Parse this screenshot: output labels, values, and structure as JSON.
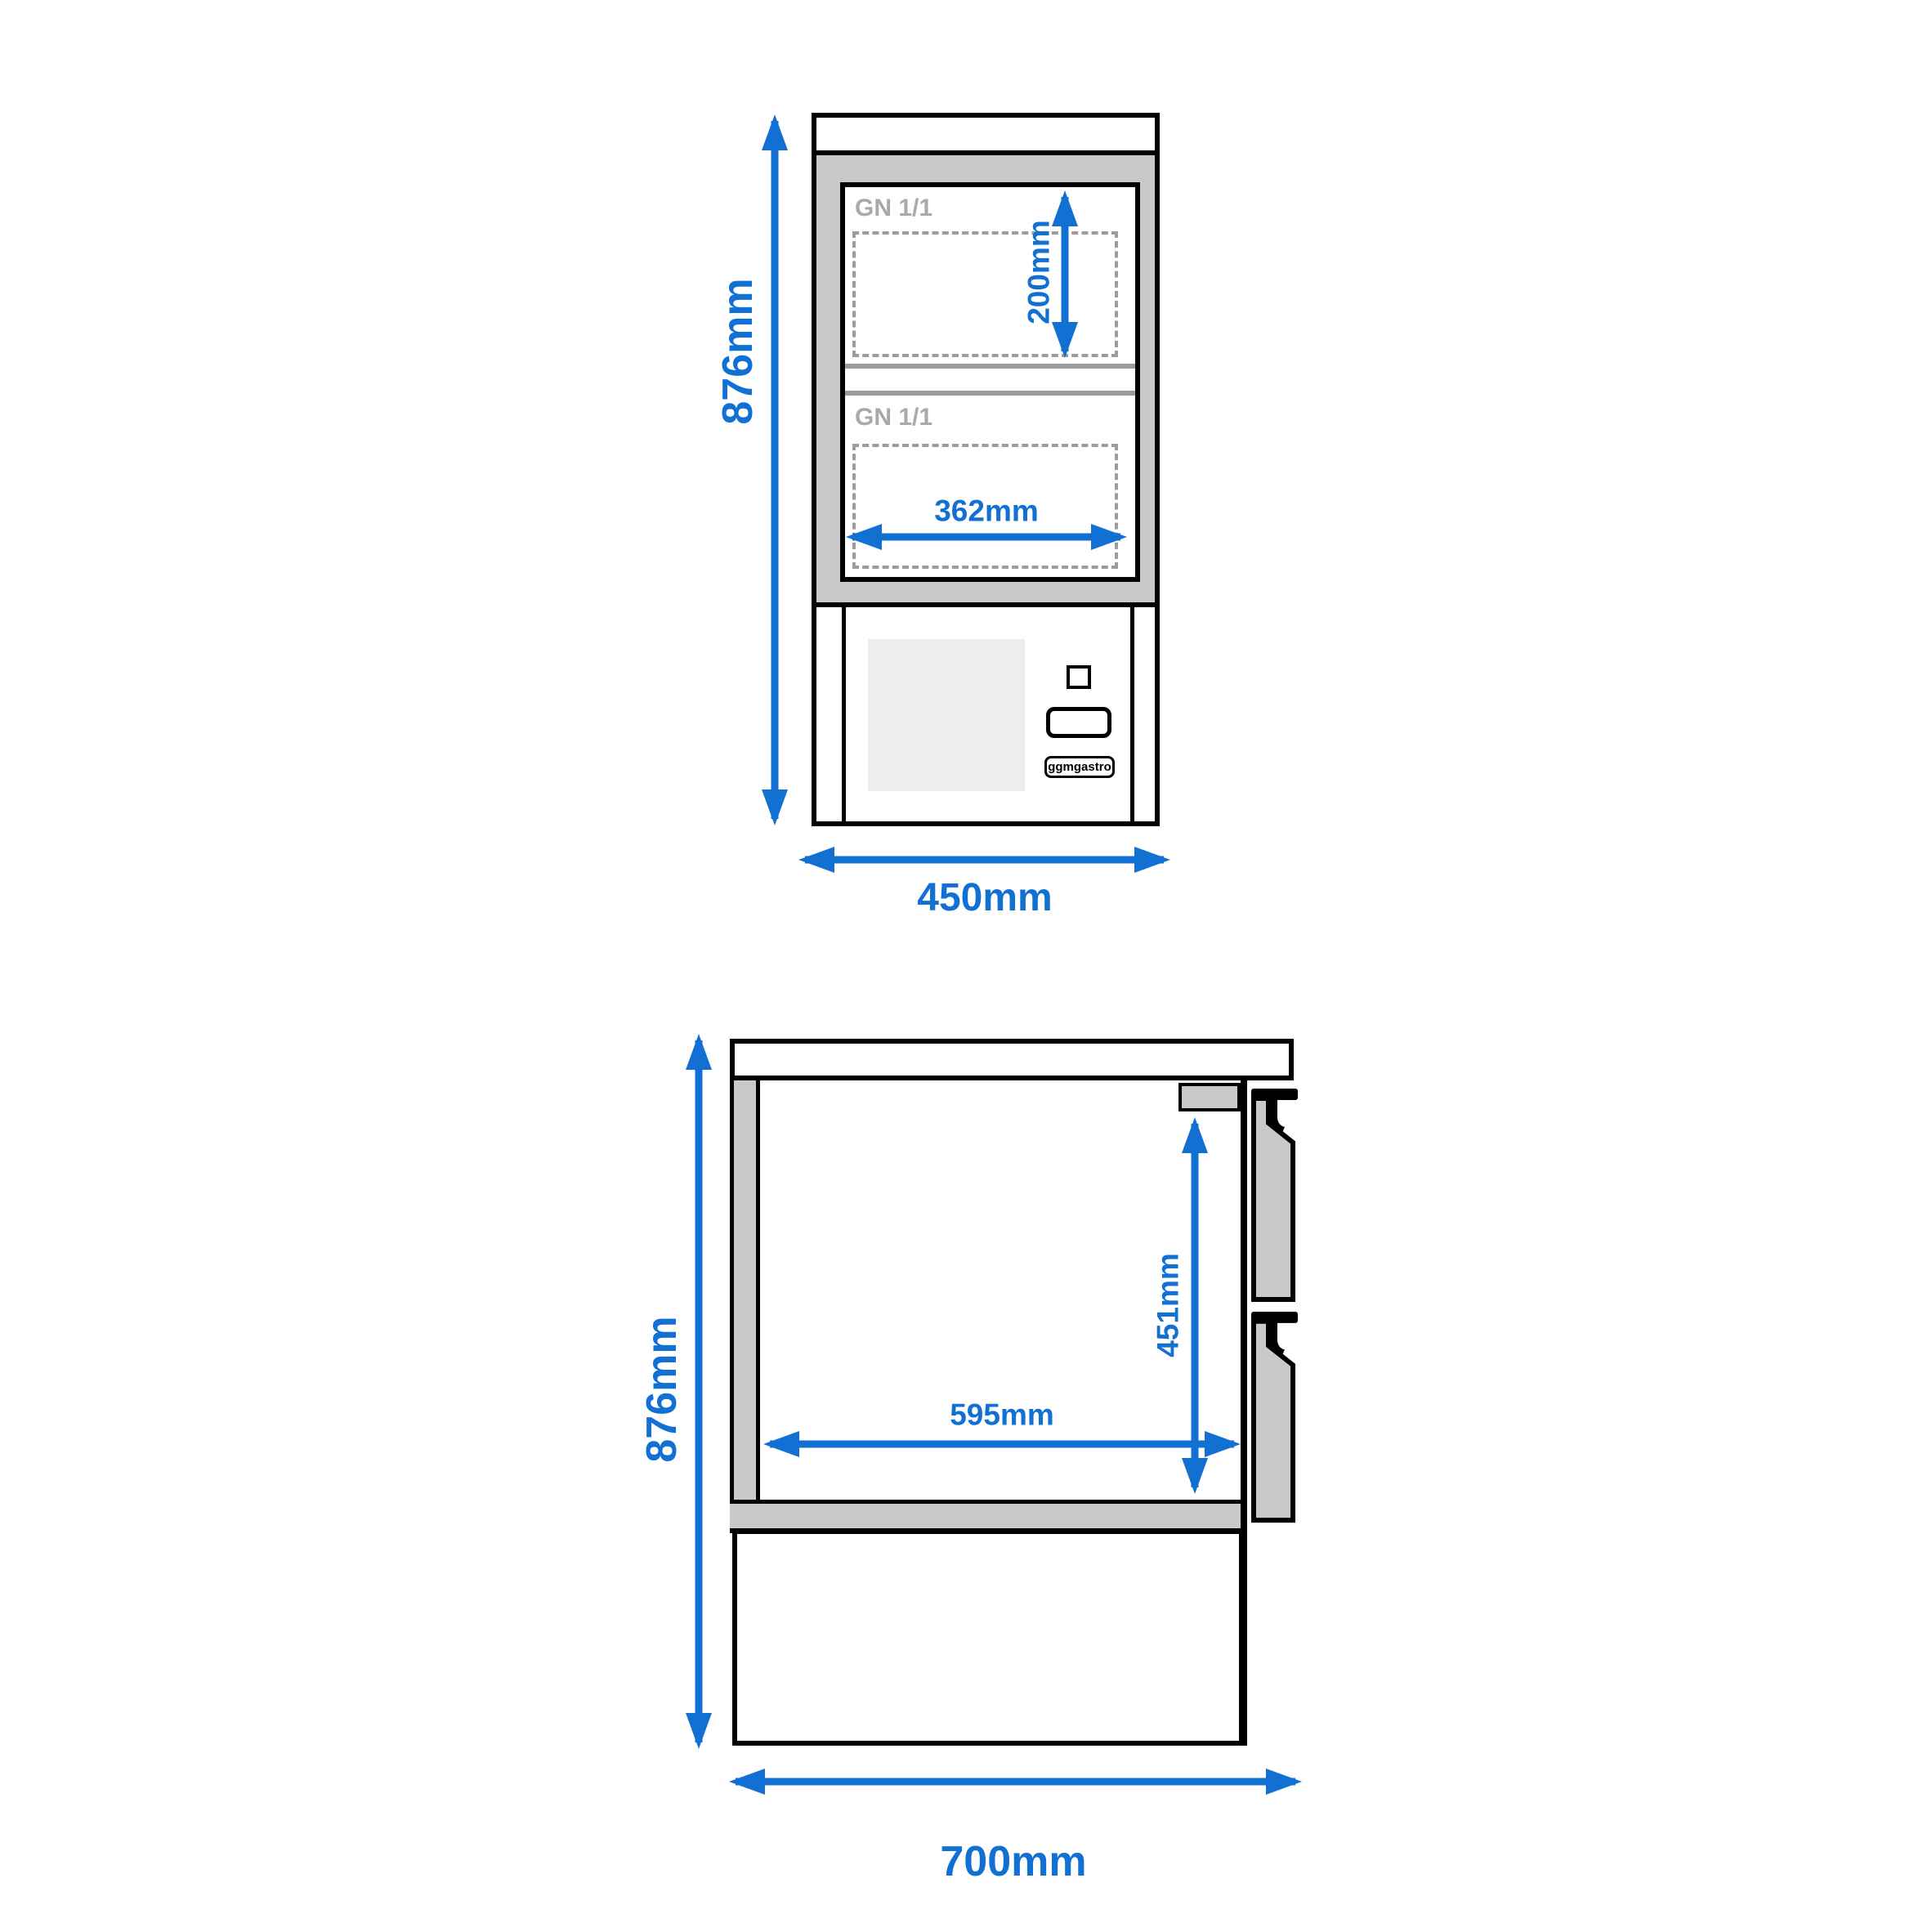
{
  "drawing": {
    "brand": "ggmgastro",
    "front_view": {
      "gn_label_top": "GN 1/1",
      "gn_label_bottom": "GN 1/1",
      "dim_height": "876mm",
      "dim_width": "450mm",
      "dim_gn_height": "200mm",
      "dim_gn_width": "362mm"
    },
    "side_view": {
      "dim_height": "876mm",
      "dim_depth": "700mm",
      "dim_inner_height": "451mm",
      "dim_inner_depth": "595mm"
    },
    "colors": {
      "dimension_blue": "#1270d2",
      "steel_gray": "#c9c9c9",
      "control_panel_gray": "#ededed",
      "gn_text_gray": "#a9a9a9",
      "dashed_outline_gray": "#9c9c9c",
      "outline_black": "#000000"
    }
  }
}
